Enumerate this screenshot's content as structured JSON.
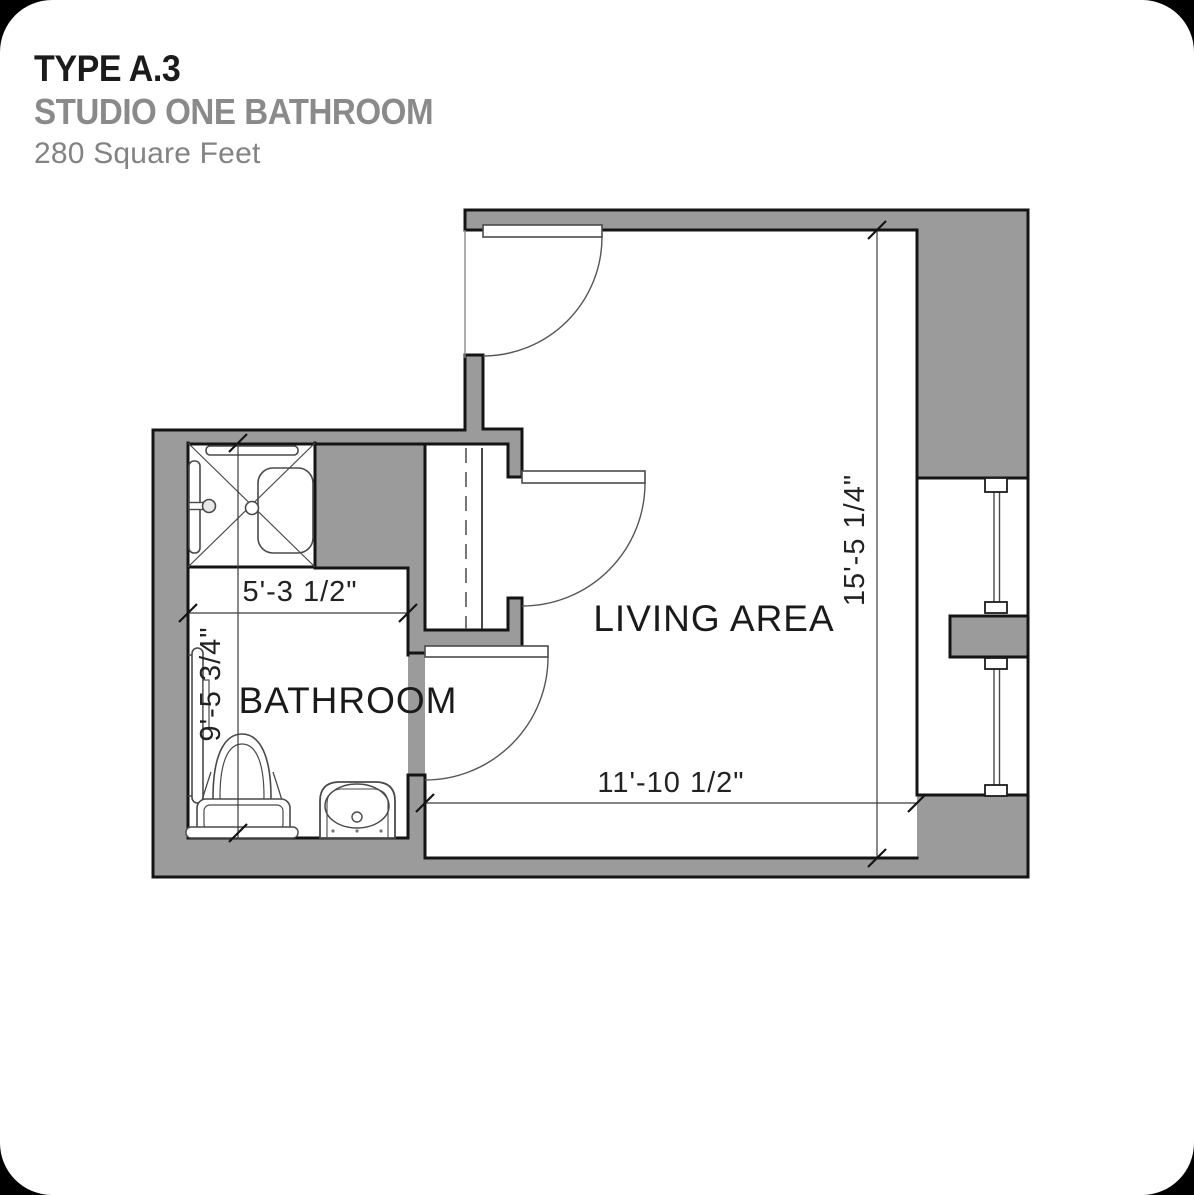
{
  "header": {
    "type_label": "TYPE A.3",
    "plan_name": "STUDIO ONE BATHROOM",
    "area": "280 Square Feet"
  },
  "plan": {
    "rooms": {
      "bathroom": "BATHROOM",
      "living": "LIVING AREA"
    },
    "dimensions": {
      "bathroom_width": "5'-3 1/2\"",
      "bathroom_depth": "9'-5 3/4\"",
      "living_depth": "15'-5 1/4\"",
      "living_width": "11'-10 1/2\""
    },
    "fixtures": [
      "shower-with-seat-and-grab-bars",
      "toilet",
      "lavatory-sink",
      "wall-grab-bar",
      "closet-with-rod-and-shelf",
      "entry-door",
      "bathroom-door",
      "closet-door",
      "window-wall-two-lites"
    ],
    "colors": {
      "wall_fill": "#9b9b9b",
      "wall_line": "#141414",
      "fixture_line": "#3a3a3a",
      "background": "#ffffff",
      "outside_corners": "#000000",
      "muted_text": "#8a8a8a"
    }
  }
}
